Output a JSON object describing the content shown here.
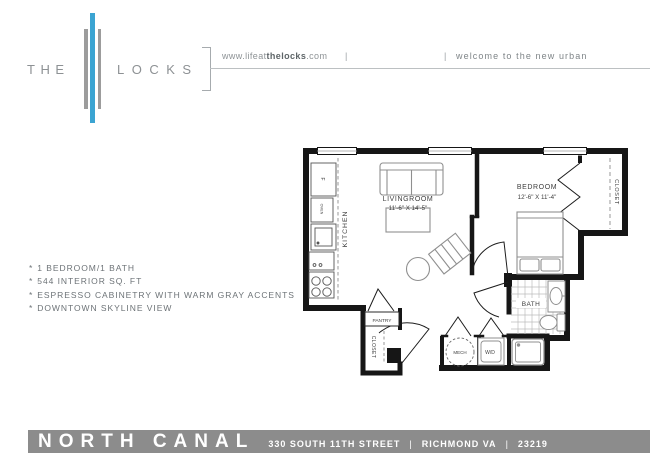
{
  "header": {
    "brand_the": "THE",
    "brand_locks": "LOCKS",
    "url_prefix": "www.lifeat",
    "url_bold": "thelocks",
    "url_suffix": ".com",
    "divider": "|",
    "tagline": "welcome to the new urban"
  },
  "features": {
    "bullet": "*",
    "items": [
      "1 BEDROOM/1 BATH",
      "544 INTERIOR SQ. FT",
      "ESPRESSO CABINETRY WITH WARM GRAY ACCENTS",
      "DOWNTOWN SKYLINE VIEW"
    ]
  },
  "floorplan": {
    "livingroom_label": "LIVINGROOM",
    "livingroom_dims": "11'-6\" X 14'-5\"",
    "bedroom_label": "BEDROOM",
    "bedroom_dims": "12'-6\" X 11'-4\"",
    "kitchen_label": "KITCHEN",
    "bath_label": "BATH",
    "closet_bedroom_label": "CLOSET",
    "closet_entry_label": "CLOSET",
    "pantry_label": "PANTRY",
    "mech_label": "MECH",
    "wd_label": "W/D",
    "fridge_label": "F",
    "oven_label": "OVEN"
  },
  "footer": {
    "property_name": "NORTH CANAL",
    "address": "330 SOUTH 11TH STREET",
    "divider": "|",
    "city_state": "RICHMOND VA",
    "zip": "23219"
  },
  "colors": {
    "accent_blue": "#3ba4d2",
    "logo_gray": "#9c9c9c",
    "footer_gray": "#8c8c8c",
    "wall_black": "#161616"
  }
}
